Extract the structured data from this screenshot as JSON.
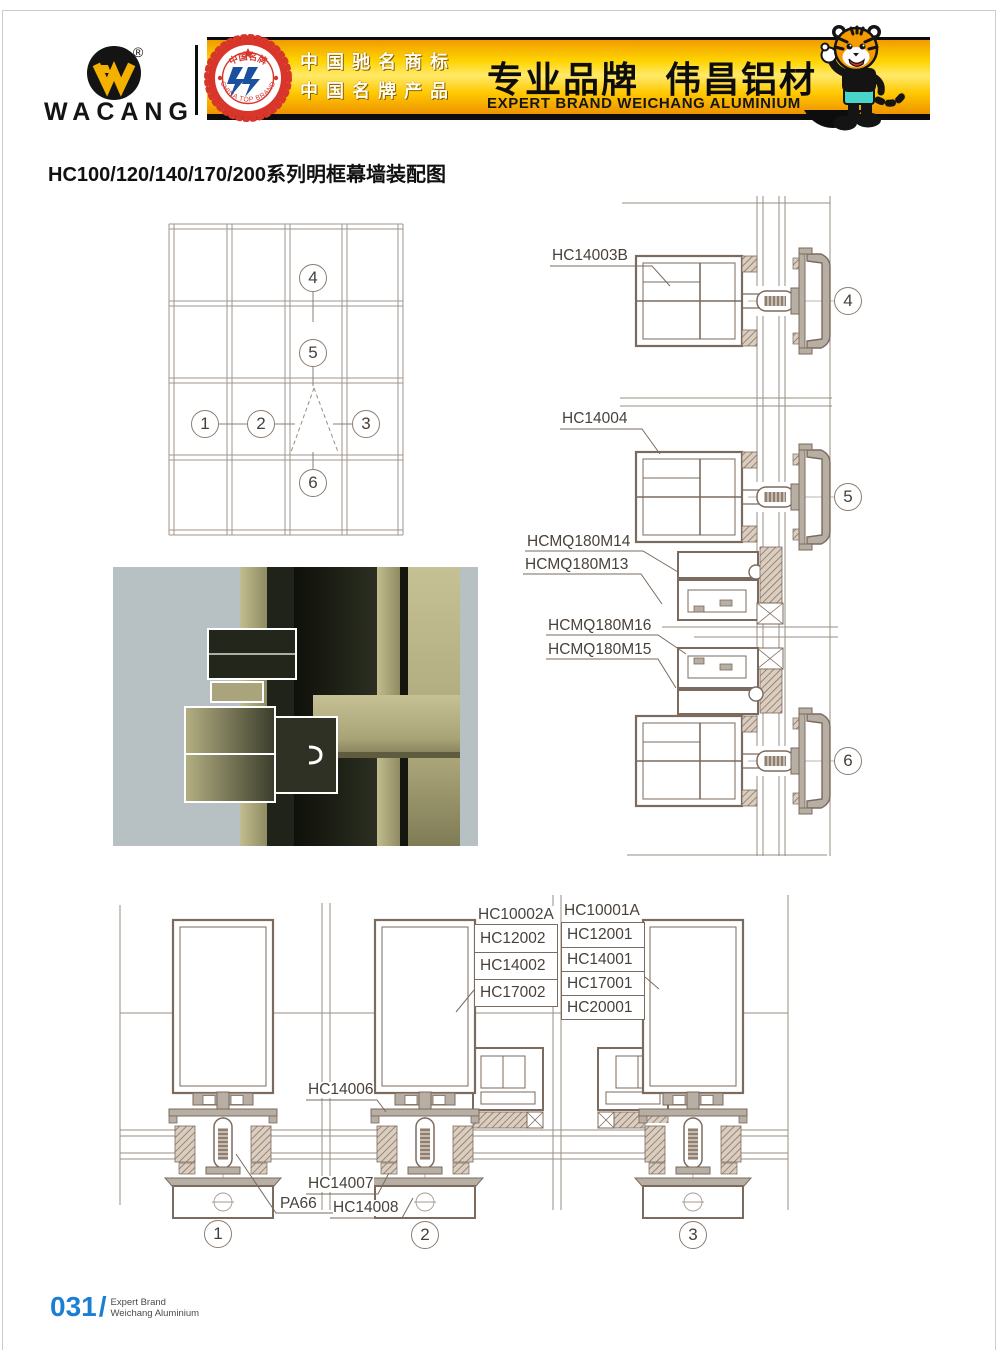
{
  "header": {
    "logo": {
      "brand": "WACANG",
      "registered_mark": "®"
    },
    "emblem": {
      "arc_top": "中国名牌",
      "arc_bottom": "CHINA TOP BRAND"
    },
    "banner": {
      "honor_line1": "中国驰名商标",
      "honor_line2": "中国名牌产品",
      "slogan_cn": "专业品牌",
      "brand_cn": "伟昌铝材",
      "slogan_en": "EXPERT BRAND WEICHANG ALUMINIUM"
    }
  },
  "doc_title": "HC100/120/140/170/200系列明框幕墙装配图",
  "callouts": {
    "n1": "1",
    "n2": "2",
    "n3": "3",
    "n4": "4",
    "n5": "5",
    "n6": "6"
  },
  "right_details": {
    "label_d4": "HC14003B",
    "label_d5": "HC14004",
    "label_m14": "HCMQ180M14",
    "label_m13": "HCMQ180M13",
    "label_m16": "HCMQ180M16",
    "label_m15": "HCMQ180M15"
  },
  "bottom_details": {
    "stack_left": {
      "title": "HC10002A",
      "rows": [
        "HC12002",
        "HC14002",
        "HC17002"
      ]
    },
    "stack_right": {
      "title": "HC10001A",
      "rows": [
        "HC12001",
        "HC14001",
        "HC17001",
        "HC20001"
      ]
    },
    "label_hc14006": "HC14006",
    "label_hc14007": "HC14007",
    "label_hc14008": "HC14008",
    "label_pa66": "PA66"
  },
  "footer": {
    "page_number": "031",
    "separator": "/",
    "caption_line1": "Expert Brand",
    "caption_line2": "Weichang Aluminium"
  },
  "colors": {
    "banner_yellow": "#ffd400",
    "banner_orange": "#ee9200",
    "page_number_blue": "#1a7fd4",
    "drawing_line": "#7b6a5e",
    "profile_fill": "#b7aea4",
    "photo_khaki": "#a9a47b",
    "photo_background": "#b7c1c3",
    "seal_red": "#d8352b",
    "seal_blue": "#1b4fa0",
    "tiger_orange": "#f59b00"
  }
}
